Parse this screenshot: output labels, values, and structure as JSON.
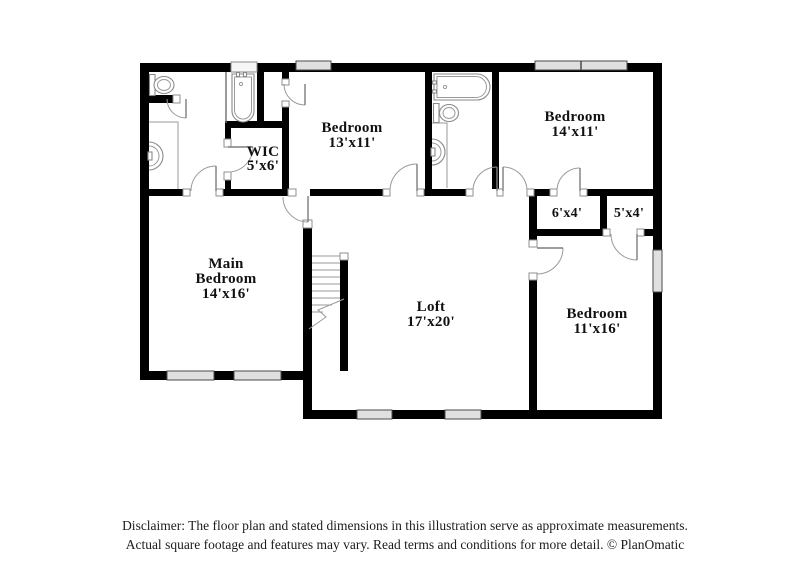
{
  "colors": {
    "background": "#ffffff",
    "wall": "#000000",
    "fixture_outline": "#8a8a8a",
    "window_fill": "#e0e0e0",
    "label_text": "#111111",
    "disclaimer_text": "#1c1c1c"
  },
  "rooms": [
    {
      "id": "bedroom-13x11",
      "line1": "Bedroom",
      "line2": "13'x11'"
    },
    {
      "id": "bedroom-14x11",
      "line1": "Bedroom",
      "line2": "14'x11'"
    },
    {
      "id": "wic",
      "line1": "WIC",
      "line2": "5'x6'"
    },
    {
      "id": "main-bedroom",
      "line1": "Main",
      "line2": "Bedroom",
      "line3": "14'x16'"
    },
    {
      "id": "loft",
      "line1": "Loft",
      "line2": "17'x20'"
    },
    {
      "id": "closet-6x4",
      "line1": "6'x4'"
    },
    {
      "id": "closet-5x4",
      "line1": "5'x4'"
    },
    {
      "id": "bedroom-11x16",
      "line1": "Bedroom",
      "line2": "11'x16'"
    }
  ],
  "fixtures_present": [
    "bathtub",
    "toilet",
    "sink",
    "vanity-counter",
    "staircase",
    "door-swing",
    "window"
  ],
  "disclaimer": {
    "line1": "Disclaimer: The floor plan and stated dimensions in this illustration serve as approximate measurements.",
    "line2": "Actual square footage and features may vary. Read terms and conditions for more detail. © PlanOmatic"
  },
  "branding": "PlanOmatic"
}
